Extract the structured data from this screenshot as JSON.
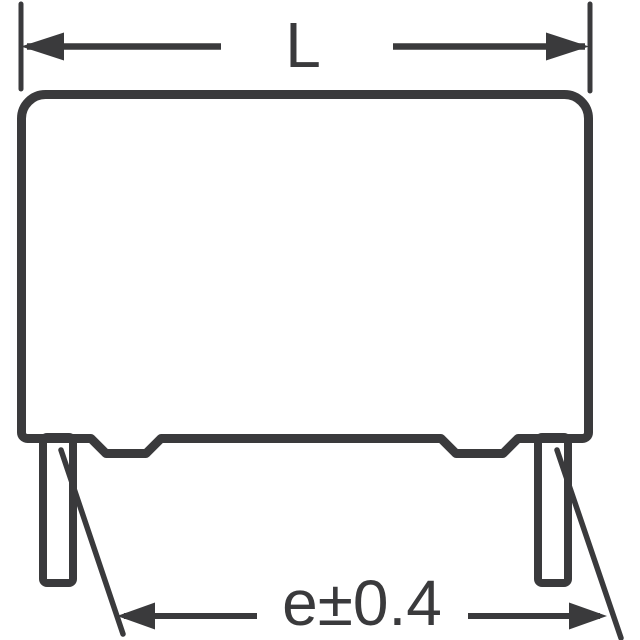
{
  "labels": {
    "length": "L",
    "pitch": "e±0.4"
  },
  "colors": {
    "line": "#3a3a3c",
    "background": "#ffffff"
  }
}
